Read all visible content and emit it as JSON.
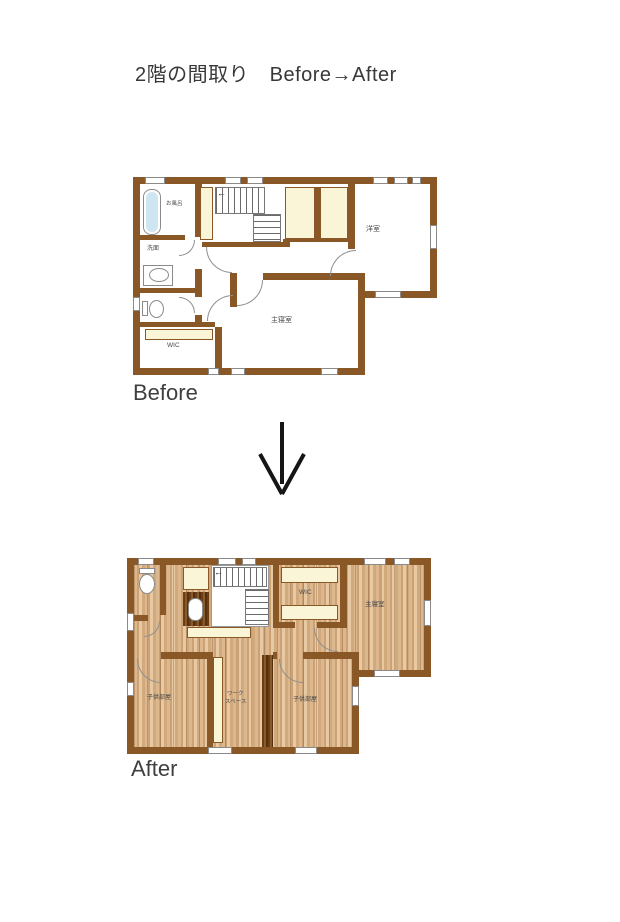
{
  "title": "2階の間取り　Before→After",
  "before": {
    "caption": "Before",
    "rooms": {
      "bath": "お風呂",
      "washroom": "洗面",
      "wic": "WIC",
      "master_bedroom": "主寝室",
      "western_room": "洋室"
    }
  },
  "after": {
    "caption": "After",
    "rooms": {
      "wic": "WIC",
      "master_bedroom": "主寝室",
      "kids_room_left": "子供部屋",
      "work_space_line1": "ワーク",
      "work_space_line2": "スペース",
      "kids_room_right": "子供部屋"
    }
  },
  "icons": {
    "stairs_arrow_glyph": "←",
    "transition_arrow": "down-arrow"
  },
  "colors": {
    "wall": "#8a5827",
    "closet_fill": "#faf5d6",
    "bathtub_fill": "#cfe6f2",
    "wood_floor": "#d5ad7f",
    "accent_text": "#3f3f3f"
  }
}
